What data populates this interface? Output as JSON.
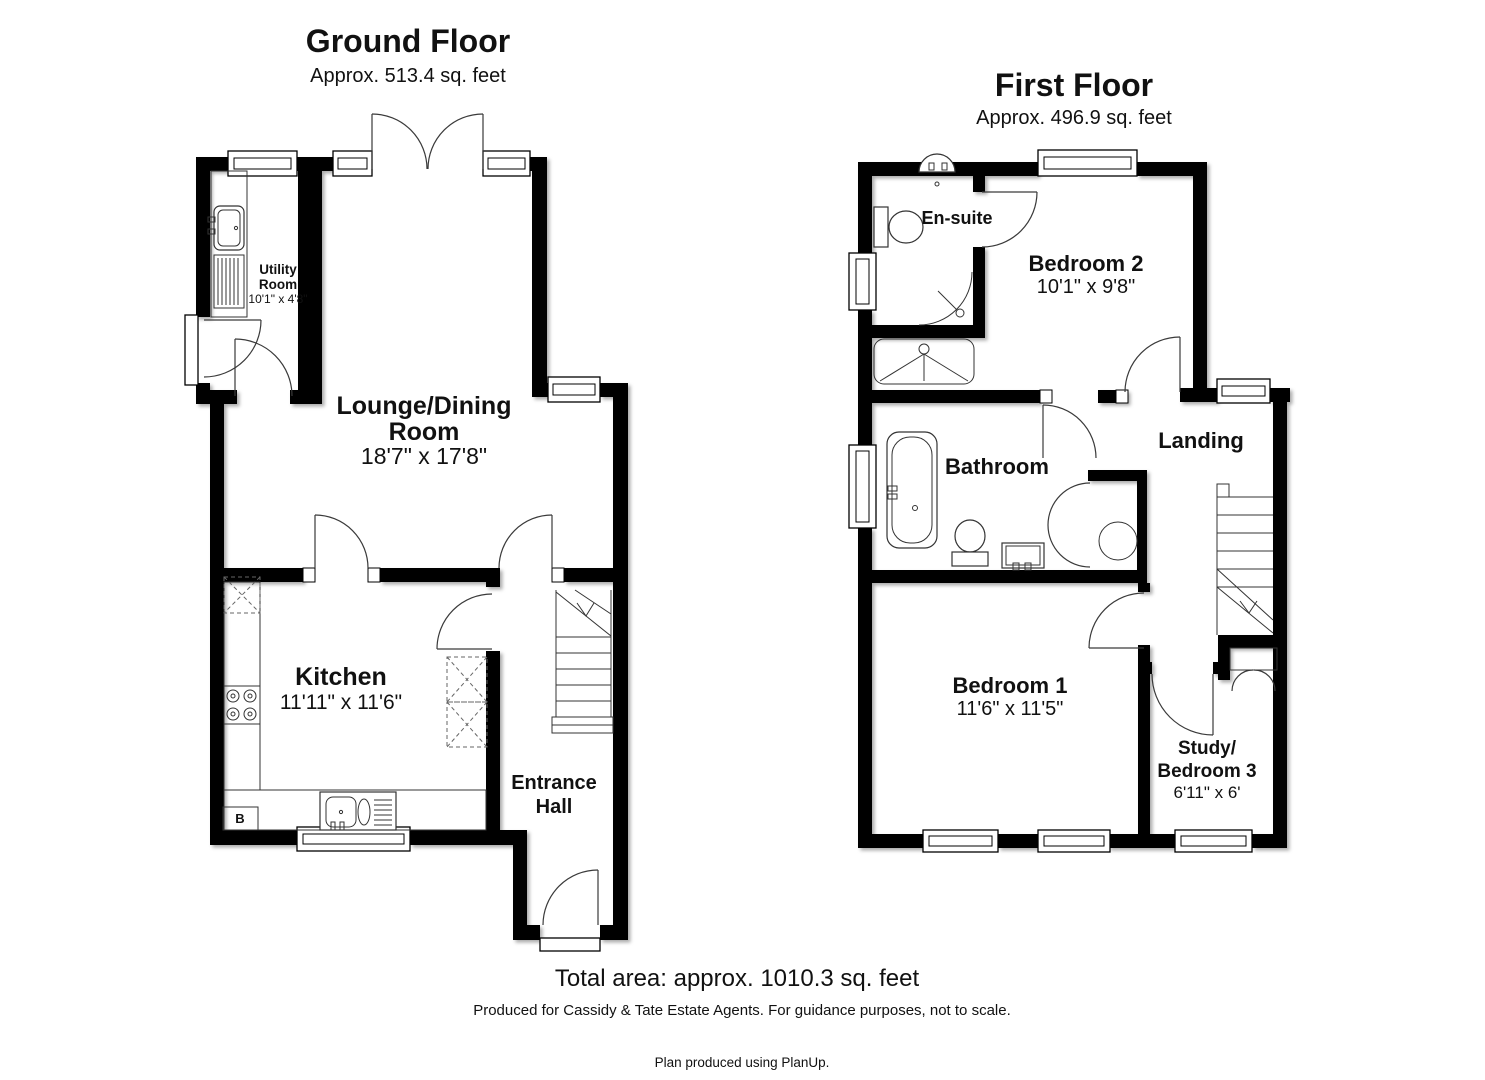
{
  "ground_floor": {
    "title": "Ground Floor",
    "area": "Approx. 513.4 sq. feet",
    "rooms": {
      "utility": {
        "name_line1": "Utility",
        "name_line2": "Room",
        "dims": "10'1\" x 4'8\""
      },
      "lounge": {
        "name_line1": "Lounge/Dining",
        "name_line2": "Room",
        "dims": "18'7\" x 17'8\""
      },
      "kitchen": {
        "name": "Kitchen",
        "dims": "11'11\" x 11'6\""
      },
      "entrance": {
        "name_line1": "Entrance",
        "name_line2": "Hall"
      }
    },
    "boiler_label": "B"
  },
  "first_floor": {
    "title": "First Floor",
    "area": "Approx. 496.9 sq. feet",
    "rooms": {
      "ensuite": {
        "name": "En-suite"
      },
      "bedroom2": {
        "name": "Bedroom 2",
        "dims": "10'1\" x 9'8\""
      },
      "bathroom": {
        "name": "Bathroom"
      },
      "landing": {
        "name": "Landing"
      },
      "bedroom1": {
        "name": "Bedroom 1",
        "dims": "11'6\" x 11'5\""
      },
      "study": {
        "name_line1": "Study/",
        "name_line2": "Bedroom 3",
        "dims": "6'11\" x 6'"
      }
    }
  },
  "footer": {
    "total_area": "Total area: approx. 1010.3 sq. feet",
    "disclaimer": "Produced for Cassidy & Tate Estate Agents. For guidance purposes, not to scale.",
    "credit": "Plan produced using PlanUp."
  },
  "colors": {
    "walls": "#000000",
    "background": "#ffffff",
    "linework": "#3a3a3a"
  }
}
